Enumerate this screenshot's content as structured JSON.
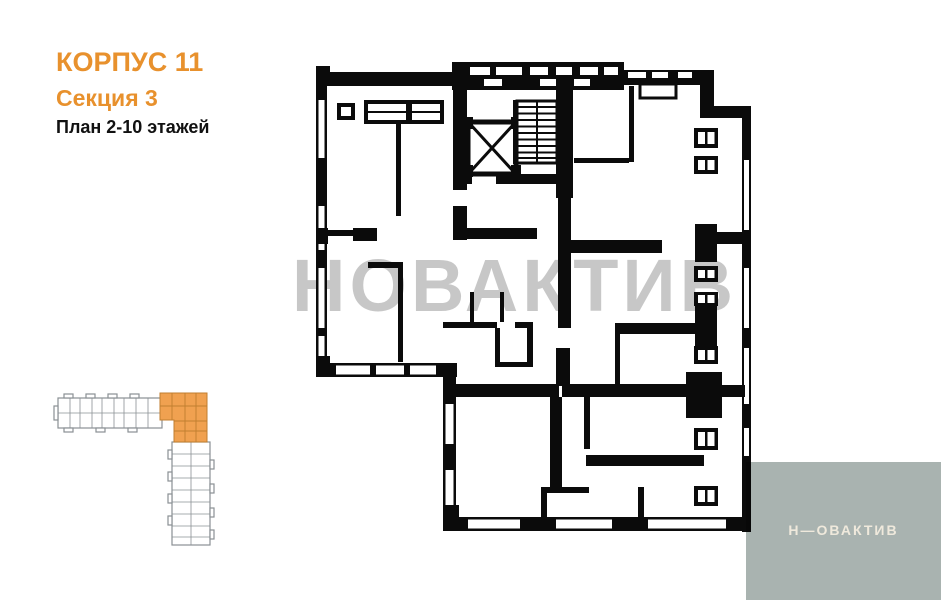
{
  "header": {
    "building": "КОРПУС 11",
    "section": "Секция 3",
    "floors": "План 2-10 этажей",
    "accent_color": "#E8912D"
  },
  "watermark": {
    "text": "НОВАКТИВ"
  },
  "logo": {
    "text": "Н—ОВАКТИВ",
    "box_color": "#A9B3B0",
    "text_color": "#EFE9DC"
  },
  "floorplan": {
    "wall_color": "#0B0B0B",
    "features": [
      "elevator-shaft",
      "staircase",
      "windows",
      "balcony-doors"
    ]
  },
  "keyplan": {
    "highlight_color": "#F0A150",
    "outline_color": "#8A9094",
    "highlighted_part": "corner-section"
  }
}
